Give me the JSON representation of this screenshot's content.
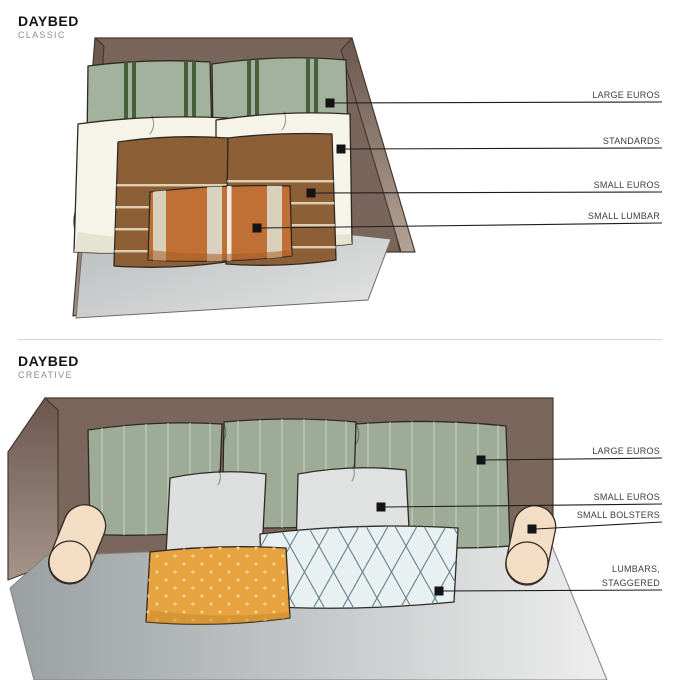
{
  "page": {
    "background": "#ffffff"
  },
  "sections": [
    {
      "title": "DAYBED",
      "subtitle": "CLASSIC",
      "labels": [
        {
          "lines": [
            "LARGE EUROS"
          ]
        },
        {
          "lines": [
            "STANDARDS"
          ]
        },
        {
          "lines": [
            "SMALL EUROS"
          ]
        },
        {
          "lines": [
            "SMALL LUMBAR"
          ]
        }
      ]
    },
    {
      "title": "DAYBED",
      "subtitle": "CREATIVE",
      "labels": [
        {
          "lines": [
            "LARGE EUROS"
          ]
        },
        {
          "lines": [
            "SMALL EUROS"
          ]
        },
        {
          "lines": [
            "SMALL BOLSTERS"
          ]
        },
        {
          "lines": [
            "LUMBARS,",
            "STAGGERED"
          ]
        }
      ]
    }
  ],
  "colors": {
    "wall_brown": "#7a655a",
    "wall_light": "#b2a294",
    "mattress_gray": "#c4c6c7",
    "mattress_light": "#ecedee",
    "sage_green": "#a3b29d",
    "stripe_dark_green": "#47603a",
    "pinstripe_light": "#c7d2c1",
    "cream_standard": "#f6f3e9",
    "brown_euro": "#8c5f36",
    "brown_euro_stripe": "#e8dcc0",
    "lumbar_orange": "#c06f35",
    "lumbar_beige": "#d8d0ba",
    "mustard": "#e6a33f",
    "mustard_dot": "#f6cd8a",
    "pale_blue": "#e9f0f1",
    "lattice_blue": "#64808b",
    "bolster_cream": "#f3ddc5",
    "ink": "#1d1d1d",
    "label_gray": "#3e3e3e"
  }
}
